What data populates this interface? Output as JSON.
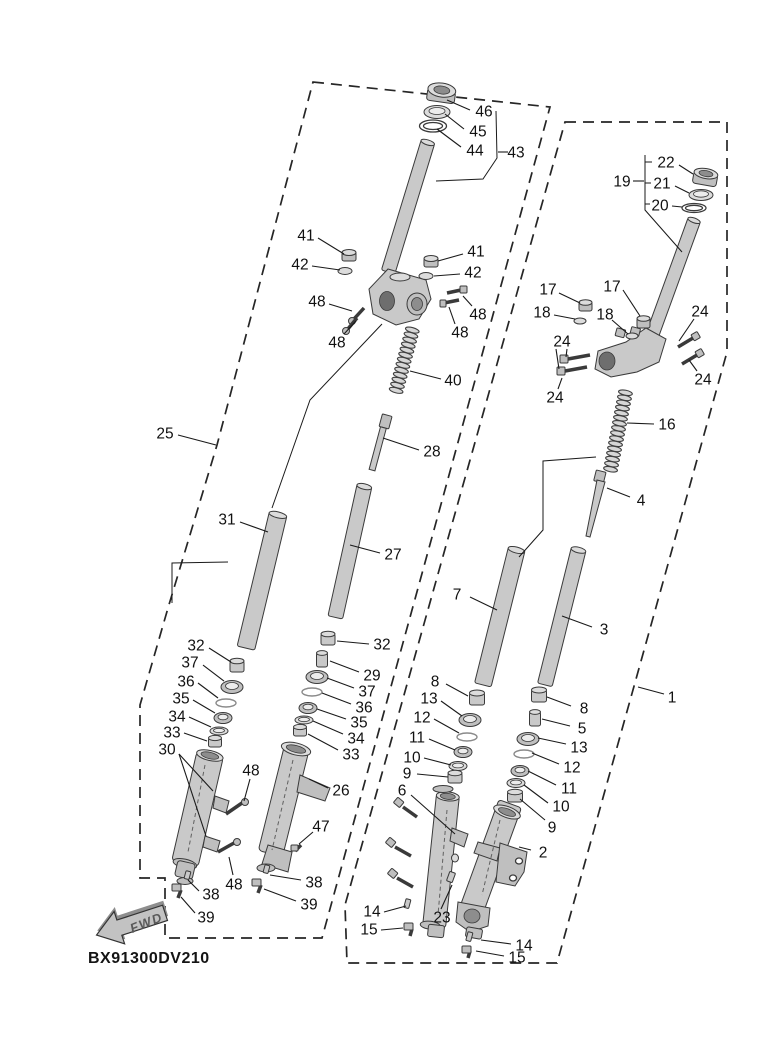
{
  "meta": {
    "code": "BX91300DV210",
    "fwd_label": "FWD"
  },
  "colors": {
    "line": "#1a1a1a",
    "part_fill": "#c9c9c9",
    "part_dark": "#8d8d8d",
    "background": "#ffffff"
  },
  "labels": [
    {
      "t": "46",
      "x": 484,
      "y": 111,
      "l": [
        [
          470,
          110,
          447,
          100
        ]
      ]
    },
    {
      "t": "45",
      "x": 478,
      "y": 131,
      "l": [
        [
          464,
          129,
          445,
          114
        ]
      ]
    },
    {
      "t": "44",
      "x": 475,
      "y": 150,
      "l": [
        [
          461,
          147,
          437,
          129
        ]
      ]
    },
    {
      "t": "43",
      "x": 516,
      "y": 152,
      "l": [
        [
          508,
          152,
          498,
          152
        ]
      ]
    },
    {
      "t": "41",
      "x": 306,
      "y": 235,
      "l": [
        [
          318,
          238,
          344,
          254
        ]
      ]
    },
    {
      "t": "42",
      "x": 300,
      "y": 264,
      "l": [
        [
          312,
          266,
          340,
          270
        ]
      ]
    },
    {
      "t": "41",
      "x": 476,
      "y": 251,
      "l": [
        [
          463,
          254,
          438,
          261
        ]
      ]
    },
    {
      "t": "42",
      "x": 473,
      "y": 272,
      "l": [
        [
          460,
          274,
          434,
          276
        ]
      ]
    },
    {
      "t": "48",
      "x": 317,
      "y": 301,
      "l": [
        [
          329,
          304,
          352,
          311
        ]
      ]
    },
    {
      "t": "48",
      "x": 337,
      "y": 342,
      "l": [
        [
          344,
          334,
          356,
          321
        ]
      ]
    },
    {
      "t": "48",
      "x": 478,
      "y": 314,
      "l": [
        [
          472,
          306,
          463,
          296
        ]
      ]
    },
    {
      "t": "48",
      "x": 460,
      "y": 332,
      "l": [
        [
          455,
          324,
          449,
          307
        ]
      ]
    },
    {
      "t": "40",
      "x": 453,
      "y": 380,
      "l": [
        [
          441,
          379,
          410,
          371
        ]
      ]
    },
    {
      "t": "25",
      "x": 165,
      "y": 433,
      "l": [
        [
          178,
          435,
          216,
          445
        ]
      ]
    },
    {
      "t": "31",
      "x": 227,
      "y": 519,
      "l": [
        [
          240,
          522,
          268,
          532
        ]
      ]
    },
    {
      "t": "28",
      "x": 432,
      "y": 451,
      "l": [
        [
          419,
          450,
          383,
          438
        ]
      ]
    },
    {
      "t": "27",
      "x": 393,
      "y": 554,
      "l": [
        [
          380,
          553,
          350,
          545
        ]
      ]
    },
    {
      "t": "32",
      "x": 196,
      "y": 645,
      "l": [
        [
          209,
          648,
          231,
          662
        ]
      ]
    },
    {
      "t": "37",
      "x": 190,
      "y": 662,
      "l": [
        [
          203,
          665,
          224,
          681
        ]
      ]
    },
    {
      "t": "36",
      "x": 186,
      "y": 681,
      "l": [
        [
          198,
          683,
          218,
          698
        ]
      ]
    },
    {
      "t": "35",
      "x": 181,
      "y": 698,
      "l": [
        [
          193,
          700,
          215,
          713
        ]
      ]
    },
    {
      "t": "34",
      "x": 177,
      "y": 716,
      "l": [
        [
          189,
          717,
          211,
          727
        ]
      ]
    },
    {
      "t": "33",
      "x": 172,
      "y": 732,
      "l": [
        [
          184,
          733,
          207,
          741
        ]
      ]
    },
    {
      "t": "30",
      "x": 167,
      "y": 749,
      "l": [
        [
          179,
          754,
          213,
          791
        ],
        [
          179,
          754,
          206,
          836
        ]
      ]
    },
    {
      "t": "32",
      "x": 382,
      "y": 644,
      "l": [
        [
          369,
          644,
          337,
          641
        ]
      ]
    },
    {
      "t": "29",
      "x": 372,
      "y": 675,
      "l": [
        [
          359,
          672,
          330,
          661
        ]
      ]
    },
    {
      "t": "37",
      "x": 367,
      "y": 691,
      "l": [
        [
          354,
          688,
          327,
          678
        ]
      ]
    },
    {
      "t": "36",
      "x": 364,
      "y": 707,
      "l": [
        [
          351,
          704,
          322,
          693
        ]
      ]
    },
    {
      "t": "35",
      "x": 359,
      "y": 722,
      "l": [
        [
          346,
          719,
          317,
          709
        ]
      ]
    },
    {
      "t": "34",
      "x": 356,
      "y": 738,
      "l": [
        [
          343,
          734,
          313,
          721
        ]
      ]
    },
    {
      "t": "33",
      "x": 351,
      "y": 754,
      "l": [
        [
          338,
          750,
          308,
          734
        ]
      ]
    },
    {
      "t": "26",
      "x": 341,
      "y": 790,
      "l": [
        [
          328,
          788,
          309,
          779
        ]
      ]
    },
    {
      "t": "47",
      "x": 321,
      "y": 826,
      "l": [
        [
          313,
          832,
          299,
          844
        ]
      ]
    },
    {
      "t": "48",
      "x": 251,
      "y": 770,
      "l": [
        [
          250,
          779,
          244,
          801
        ]
      ]
    },
    {
      "t": "48",
      "x": 234,
      "y": 884,
      "l": [
        [
          233,
          875,
          229,
          857
        ]
      ]
    },
    {
      "t": "38",
      "x": 211,
      "y": 894,
      "l": [
        [
          199,
          891,
          188,
          880
        ]
      ]
    },
    {
      "t": "39",
      "x": 206,
      "y": 917,
      "l": [
        [
          195,
          913,
          181,
          897
        ]
      ]
    },
    {
      "t": "38",
      "x": 314,
      "y": 882,
      "l": [
        [
          301,
          880,
          270,
          875
        ]
      ]
    },
    {
      "t": "39",
      "x": 309,
      "y": 904,
      "l": [
        [
          296,
          901,
          264,
          889
        ]
      ]
    },
    {
      "t": "19",
      "x": 622,
      "y": 181,
      "l": [
        [
          633,
          181,
          644,
          181
        ]
      ]
    },
    {
      "t": "22",
      "x": 666,
      "y": 162,
      "l": [
        [
          679,
          165,
          693,
          174
        ]
      ]
    },
    {
      "t": "21",
      "x": 662,
      "y": 183,
      "l": [
        [
          675,
          186,
          689,
          193
        ]
      ]
    },
    {
      "t": "20",
      "x": 660,
      "y": 205,
      "l": [
        [
          672,
          206,
          682,
          207
        ]
      ]
    },
    {
      "t": "17",
      "x": 548,
      "y": 289,
      "l": [
        [
          559,
          293,
          580,
          303
        ]
      ]
    },
    {
      "t": "18",
      "x": 542,
      "y": 312,
      "l": [
        [
          554,
          315,
          575,
          319
        ]
      ]
    },
    {
      "t": "17",
      "x": 612,
      "y": 286,
      "l": [
        [
          623,
          290,
          640,
          316
        ]
      ]
    },
    {
      "t": "18",
      "x": 605,
      "y": 314,
      "l": [
        [
          612,
          320,
          628,
          334
        ]
      ]
    },
    {
      "t": "24",
      "x": 700,
      "y": 311,
      "l": [
        [
          694,
          319,
          679,
          341
        ]
      ]
    },
    {
      "t": "24",
      "x": 562,
      "y": 341,
      "l": [
        [
          567,
          349,
          566,
          357
        ],
        [
          556,
          349,
          559,
          369
        ]
      ]
    },
    {
      "t": "24",
      "x": 555,
      "y": 397,
      "l": [
        [
          558,
          389,
          562,
          378
        ]
      ]
    },
    {
      "t": "24",
      "x": 703,
      "y": 379,
      "l": [
        [
          697,
          371,
          689,
          360
        ]
      ]
    },
    {
      "t": "16",
      "x": 667,
      "y": 424,
      "l": [
        [
          654,
          424,
          627,
          423
        ]
      ]
    },
    {
      "t": "4",
      "x": 641,
      "y": 500,
      "l": [
        [
          630,
          497,
          607,
          488
        ]
      ]
    },
    {
      "t": "7",
      "x": 457,
      "y": 594,
      "l": [
        [
          470,
          597,
          497,
          610
        ]
      ]
    },
    {
      "t": "3",
      "x": 604,
      "y": 629,
      "l": [
        [
          592,
          627,
          562,
          616
        ]
      ]
    },
    {
      "t": "8",
      "x": 435,
      "y": 681,
      "l": [
        [
          446,
          684,
          468,
          696
        ]
      ]
    },
    {
      "t": "13",
      "x": 429,
      "y": 698,
      "l": [
        [
          441,
          701,
          462,
          716
        ]
      ]
    },
    {
      "t": "12",
      "x": 422,
      "y": 717,
      "l": [
        [
          434,
          719,
          459,
          733
        ]
      ]
    },
    {
      "t": "11",
      "x": 417,
      "y": 737,
      "l": [
        [
          429,
          739,
          455,
          750
        ]
      ]
    },
    {
      "t": "10",
      "x": 412,
      "y": 757,
      "l": [
        [
          424,
          758,
          451,
          765
        ]
      ]
    },
    {
      "t": "9",
      "x": 407,
      "y": 773,
      "l": [
        [
          417,
          774,
          448,
          777
        ]
      ]
    },
    {
      "t": "6",
      "x": 402,
      "y": 790,
      "l": [
        [
          411,
          795,
          455,
          834
        ]
      ]
    },
    {
      "t": "8",
      "x": 584,
      "y": 708,
      "l": [
        [
          571,
          706,
          547,
          697
        ]
      ]
    },
    {
      "t": "5",
      "x": 582,
      "y": 728,
      "l": [
        [
          570,
          726,
          542,
          719
        ]
      ]
    },
    {
      "t": "13",
      "x": 579,
      "y": 747,
      "l": [
        [
          566,
          744,
          538,
          738
        ]
      ]
    },
    {
      "t": "12",
      "x": 572,
      "y": 767,
      "l": [
        [
          559,
          764,
          532,
          753
        ]
      ]
    },
    {
      "t": "11",
      "x": 569,
      "y": 788,
      "l": [
        [
          556,
          785,
          528,
          771
        ]
      ]
    },
    {
      "t": "10",
      "x": 561,
      "y": 806,
      "l": [
        [
          548,
          803,
          524,
          785
        ]
      ]
    },
    {
      "t": "9",
      "x": 552,
      "y": 827,
      "l": [
        [
          545,
          820,
          520,
          799
        ]
      ]
    },
    {
      "t": "2",
      "x": 543,
      "y": 852,
      "l": [
        [
          531,
          850,
          519,
          847
        ]
      ]
    },
    {
      "t": "23",
      "x": 442,
      "y": 917,
      "l": [
        [
          441,
          909,
          452,
          885
        ]
      ]
    },
    {
      "t": "14",
      "x": 372,
      "y": 911,
      "l": [
        [
          384,
          912,
          406,
          906
        ]
      ]
    },
    {
      "t": "15",
      "x": 369,
      "y": 929,
      "l": [
        [
          381,
          930,
          403,
          928
        ]
      ]
    },
    {
      "t": "14",
      "x": 524,
      "y": 945,
      "l": [
        [
          511,
          944,
          481,
          940
        ]
      ]
    },
    {
      "t": "15",
      "x": 517,
      "y": 957,
      "l": [
        [
          504,
          956,
          476,
          951
        ]
      ]
    },
    {
      "t": "1",
      "x": 672,
      "y": 697,
      "l": [
        [
          664,
          694,
          638,
          687
        ]
      ]
    }
  ],
  "polylines": [
    {
      "name": "bracket-43",
      "pts": [
        [
          496,
          111
        ],
        [
          497,
          158
        ],
        [
          483,
          179
        ],
        [
          436,
          181
        ]
      ]
    },
    {
      "name": "datum-left",
      "pts": [
        [
          382,
          324
        ],
        [
          310,
          400
        ],
        [
          272,
          508
        ]
      ]
    },
    {
      "name": "datum-left-step",
      "pts": [
        [
          228,
          562
        ],
        [
          172,
          563
        ],
        [
          172,
          603
        ]
      ]
    },
    {
      "name": "bracket-19",
      "pts": [
        [
          645,
          155
        ],
        [
          645,
          210
        ],
        [
          682,
          252
        ]
      ]
    },
    {
      "name": "bracket-19-tick-22",
      "pts": [
        [
          645,
          162
        ],
        [
          652,
          162
        ]
      ]
    },
    {
      "name": "bracket-19-tick-21",
      "pts": [
        [
          645,
          183
        ],
        [
          651,
          183
        ]
      ]
    },
    {
      "name": "bracket-19-tick-20",
      "pts": [
        [
          645,
          204
        ],
        [
          650,
          204
        ]
      ]
    },
    {
      "name": "datum-right-step",
      "pts": [
        [
          596,
          457
        ],
        [
          543,
          461
        ],
        [
          543,
          530
        ],
        [
          519,
          557
        ]
      ]
    }
  ],
  "springs": [
    {
      "name": "spring-40",
      "cx": 404,
      "cy": 361,
      "rot": 15,
      "len": 64,
      "rx": 7
    },
    {
      "name": "spring-16",
      "cx": 618,
      "cy": 431,
      "rot": 11,
      "len": 78,
      "rx": 7
    }
  ]
}
